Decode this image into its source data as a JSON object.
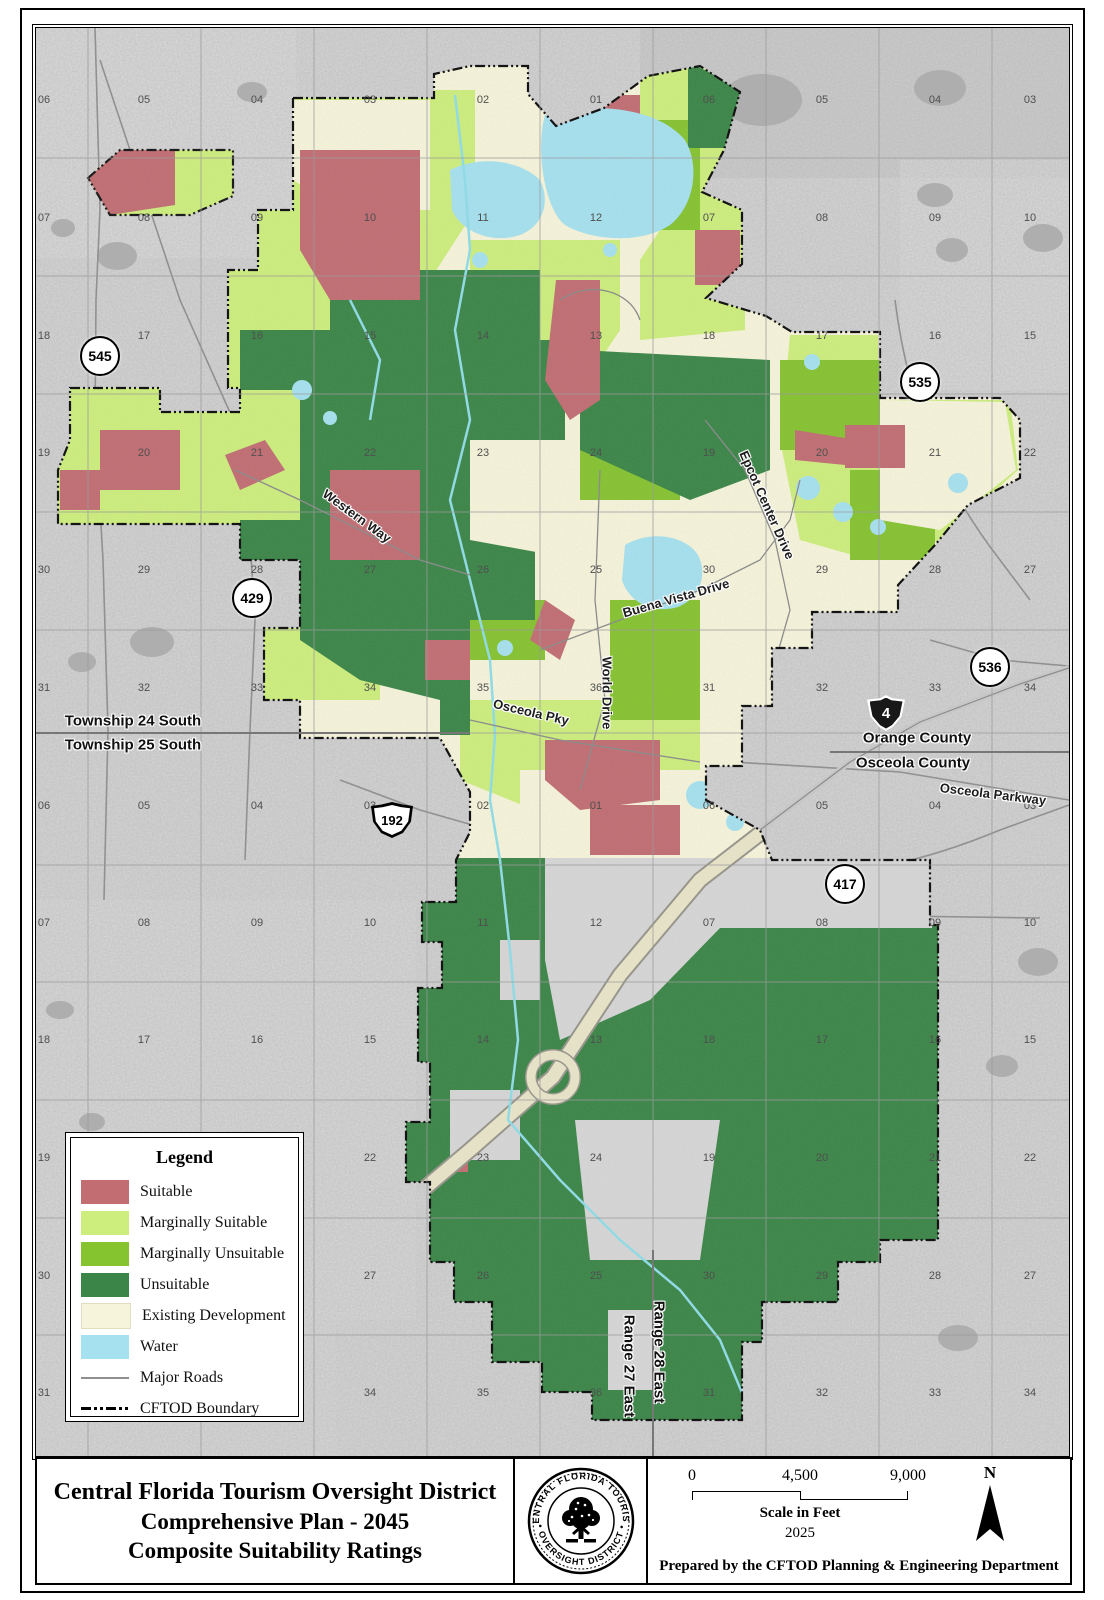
{
  "title_block": {
    "title_lines": [
      "Central Florida Tourism Oversight District",
      "Comprehensive Plan - 2045",
      "Composite Suitability Ratings"
    ],
    "prepared_by": "Prepared by the CFTOD Planning & Engineering Department",
    "scale": {
      "t0": "0",
      "t1": "4,500",
      "t2": "9,000",
      "caption": "Scale in Feet",
      "year": "2025"
    },
    "north_label": "N",
    "logo": {
      "top": "CENTRAL FLORIDA TOURISM",
      "bottom": "• OVERSIGHT DISTRICT •"
    }
  },
  "legend": {
    "title": "Legend",
    "items": [
      {
        "label": "Suitable",
        "swatch": "suitable"
      },
      {
        "label": "Marginally Suitable",
        "swatch": "marg_suitable"
      },
      {
        "label": "Marginally Unsuitable",
        "swatch": "marg_unsuitable"
      },
      {
        "label": "Unsuitable",
        "swatch": "unsuitable"
      },
      {
        "label": "Existing Development",
        "swatch": "developed"
      },
      {
        "label": "Water",
        "swatch": "water"
      },
      {
        "label": "Major Roads",
        "swatch": "roadline"
      },
      {
        "label": "CFTOD Boundary",
        "swatch": "boundaryline"
      }
    ]
  },
  "map": {
    "shields": [
      {
        "n": "545",
        "t": "circle",
        "x": 100,
        "y": 356
      },
      {
        "n": "535",
        "t": "circle",
        "x": 920,
        "y": 382
      },
      {
        "n": "429",
        "t": "circle",
        "x": 252,
        "y": 598
      },
      {
        "n": "536",
        "t": "circle",
        "x": 990,
        "y": 667
      },
      {
        "n": "417",
        "t": "circle",
        "x": 845,
        "y": 884
      },
      {
        "n": "4",
        "t": "interstate",
        "x": 886,
        "y": 713
      },
      {
        "n": "192",
        "t": "us",
        "x": 392,
        "y": 820
      }
    ],
    "labels": [
      {
        "t": "Township 24 South",
        "x": 133,
        "y": 721,
        "r": 0,
        "c": "admin"
      },
      {
        "t": "Township 25 South",
        "x": 133,
        "y": 745,
        "r": 0,
        "c": "admin"
      },
      {
        "t": "Orange County",
        "x": 917,
        "y": 738,
        "r": 0,
        "c": "admin"
      },
      {
        "t": "Osceola County",
        "x": 913,
        "y": 763,
        "r": 0,
        "c": "admin"
      },
      {
        "t": "Osceola Parkway",
        "x": 993,
        "y": 794,
        "r": 7,
        "c": "road"
      },
      {
        "t": "Western Way",
        "x": 357,
        "y": 516,
        "r": 36,
        "c": "road"
      },
      {
        "t": "Epcot Center Drive",
        "x": 767,
        "y": 505,
        "r": 66,
        "c": "road"
      },
      {
        "t": "Buena Vista Drive",
        "x": 676,
        "y": 598,
        "r": -16,
        "c": "road"
      },
      {
        "t": "World Drive",
        "x": 607,
        "y": 693,
        "r": 90,
        "c": "road"
      },
      {
        "t": "Osceola Pky",
        "x": 531,
        "y": 712,
        "r": 13,
        "c": "road"
      },
      {
        "t": "Range 27 East",
        "x": 629,
        "y": 1366,
        "r": 90,
        "c": "admin"
      },
      {
        "t": "Range 28 East",
        "x": 659,
        "y": 1352,
        "r": 90,
        "c": "admin"
      }
    ],
    "section_numbers": {
      "cols": [
        44,
        144,
        257,
        370,
        483,
        596,
        709,
        822,
        935,
        1030
      ],
      "rows": [
        {
          "y": 100,
          "labels": [
            "06",
            "05",
            "04",
            "03",
            "02",
            "01",
            "06",
            "05",
            "04",
            "03"
          ]
        },
        {
          "y": 218,
          "labels": [
            "07",
            "08",
            "09",
            "10",
            "11",
            "12",
            "07",
            "08",
            "09",
            "10"
          ]
        },
        {
          "y": 336,
          "labels": [
            "18",
            "17",
            "16",
            "15",
            "14",
            "13",
            "18",
            "17",
            "16",
            "15"
          ]
        },
        {
          "y": 453,
          "labels": [
            "19",
            "20",
            "21",
            "22",
            "23",
            "24",
            "19",
            "20",
            "21",
            "22"
          ]
        },
        {
          "y": 570,
          "labels": [
            "30",
            "29",
            "28",
            "27",
            "26",
            "25",
            "30",
            "29",
            "28",
            "27"
          ]
        },
        {
          "y": 688,
          "labels": [
            "31",
            "32",
            "33",
            "34",
            "35",
            "36",
            "31",
            "32",
            "33",
            "34"
          ]
        },
        {
          "y": 806,
          "labels": [
            "06",
            "05",
            "04",
            "03",
            "02",
            "01",
            "06",
            "05",
            "04",
            "03"
          ]
        },
        {
          "y": 923,
          "labels": [
            "07",
            "08",
            "09",
            "10",
            "11",
            "12",
            "07",
            "08",
            "09",
            "10"
          ]
        },
        {
          "y": 1040,
          "labels": [
            "18",
            "17",
            "16",
            "15",
            "14",
            "13",
            "18",
            "17",
            "16",
            "15"
          ]
        },
        {
          "y": 1158,
          "labels": [
            "19",
            "20",
            "21",
            "22",
            "23",
            "24",
            "19",
            "20",
            "21",
            "22"
          ]
        },
        {
          "y": 1276,
          "labels": [
            "30",
            "29",
            "28",
            "27",
            "26",
            "25",
            "30",
            "29",
            "28",
            "27"
          ]
        },
        {
          "y": 1393,
          "labels": [
            "31",
            "32",
            "33",
            "34",
            "35",
            "36",
            "31",
            "32",
            "33",
            "34"
          ]
        }
      ]
    }
  },
  "colors": {
    "bg": "#d6d6d6",
    "bg_dark": "#aeaeae",
    "grid": "#9b9b9b",
    "suitable": "#c16d72",
    "marg_suitable": "#cdee7c",
    "marg_unsuitable": "#85c32f",
    "unsuitable": "#3a8547",
    "developed": "#f6f4da",
    "water": "#a6e1ef",
    "stream": "#8fdde8",
    "road": "#8f8f8f",
    "road_light": "#c9c9c9",
    "corridor": "#e9e5c9",
    "corridor_edge": "#97958a",
    "boundary": "#141414"
  }
}
